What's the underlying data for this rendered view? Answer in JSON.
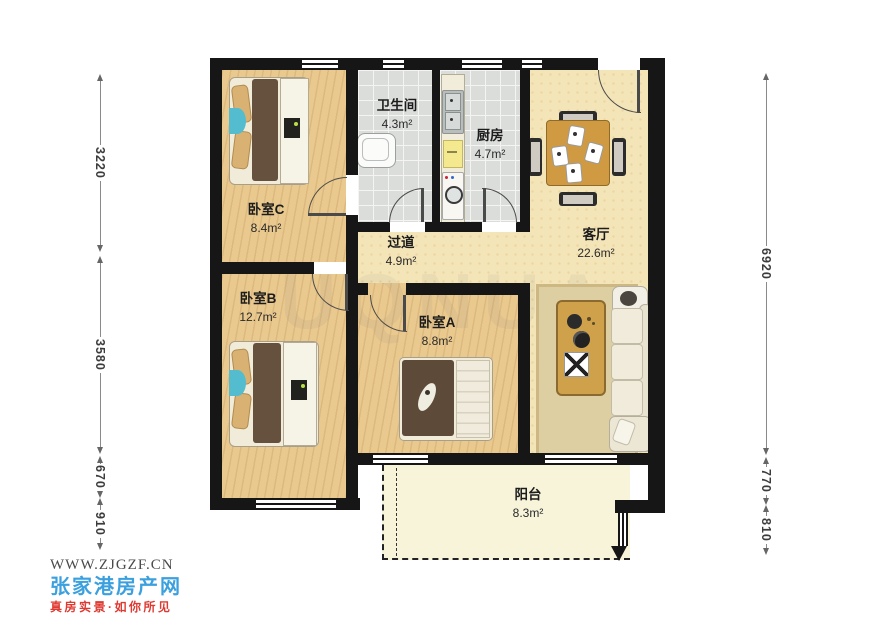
{
  "plan": {
    "rooms": [
      {
        "id": "bedroom-c",
        "name": "卧室C",
        "area": "8.4m²"
      },
      {
        "id": "bathroom",
        "name": "卫生间",
        "area": "4.3m²"
      },
      {
        "id": "kitchen",
        "name": "厨房",
        "area": "4.7m²"
      },
      {
        "id": "living",
        "name": "客厅",
        "area": "22.6m²"
      },
      {
        "id": "hallway",
        "name": "过道",
        "area": "4.9m²"
      },
      {
        "id": "bedroom-b",
        "name": "卧室B",
        "area": "12.7m²"
      },
      {
        "id": "bedroom-a",
        "name": "卧室A",
        "area": "8.8m²"
      },
      {
        "id": "balcony",
        "name": "阳台",
        "area": "8.3m²"
      }
    ],
    "dimensions": {
      "left": [
        {
          "label": "3220"
        },
        {
          "label": "3580"
        },
        {
          "label": "670"
        },
        {
          "label": "910"
        }
      ],
      "right": [
        {
          "label": "6920"
        },
        {
          "label": "770"
        },
        {
          "label": "810"
        }
      ]
    },
    "watermark": "UQNUA",
    "wall_color": "#161616",
    "wood_floor_color": "#eac98f",
    "living_floor_color": "#f4e5b8",
    "tile_floor_color": "#dbdddb",
    "balcony_floor_color": "#f7f4da"
  },
  "footer": {
    "website": "WWW.ZJGZF.CN",
    "brand": "张家港房产网",
    "slogan": "真房实景·如你所见",
    "brand_color": "#3BA0DE",
    "slogan_color": "#DE3A31"
  }
}
